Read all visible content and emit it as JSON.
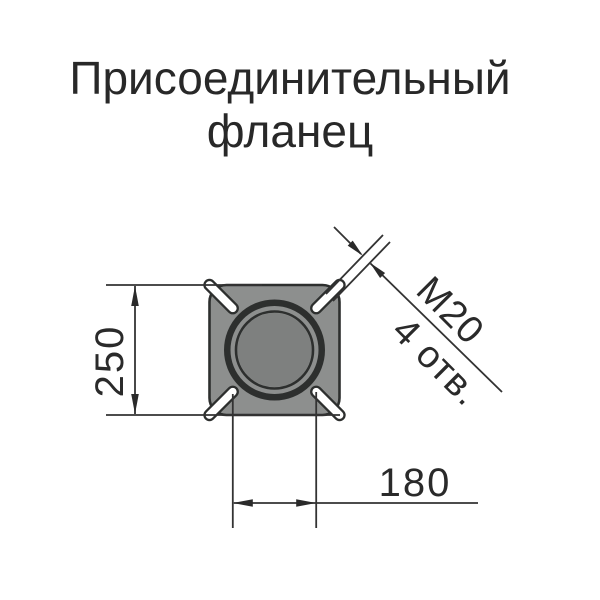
{
  "title": {
    "line1": "Присоединительный",
    "line2": "фланец"
  },
  "dimensions": {
    "flange_size": "250",
    "hole_spacing": "180",
    "thread": "M20",
    "hole_count": "4 отв."
  },
  "colors": {
    "flange_gray": "#8d8f8e",
    "bore_gray": "#7e807f",
    "line_dark": "#2d2f2e",
    "text_dark": "#282828"
  }
}
